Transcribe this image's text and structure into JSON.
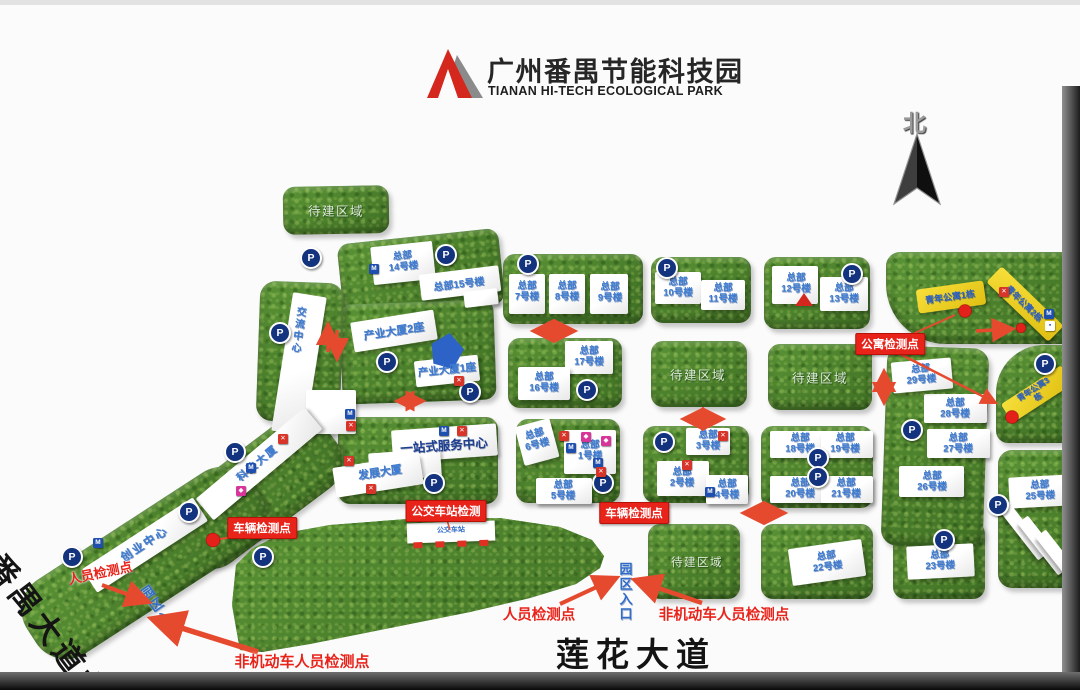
{
  "header": {
    "title": "广州番禺节能科技园",
    "subtitle": "TIANAN HI-TECH ECOLOGICAL PARK"
  },
  "compass": {
    "north": "北"
  },
  "roads": {
    "west": "番禺大道北",
    "south": "莲花大道"
  },
  "areas": {
    "pending": "待建区域"
  },
  "buildings": {
    "hq1": "总部\n1号楼",
    "hq2": "总部\n2号楼",
    "hq3": "总部\n3号楼",
    "hq4": "总部\n4号楼",
    "hq5": "总部\n5号楼",
    "hq6": "总部\n6号楼",
    "hq7": "总部\n7号楼",
    "hq8": "总部\n8号楼",
    "hq9": "总部\n9号楼",
    "hq10": "总部\n10号楼",
    "hq11": "总部\n11号楼",
    "hq12": "总部\n12号楼",
    "hq13": "总部\n13号楼",
    "hq14": "总部\n14号楼",
    "hq15": "总部15号楼",
    "hq16": "总部\n16号楼",
    "hq17": "总部\n17号楼",
    "hq18": "总部\n18号楼",
    "hq19": "总部\n19号楼",
    "hq20": "总部\n20号楼",
    "hq21": "总部\n21号楼",
    "hq22": "总部\n22号楼",
    "hq23": "总部\n23号楼",
    "hq25": "总部\n25号楼",
    "hq26": "总部\n26号楼",
    "hq27": "总部\n27号楼",
    "hq28": "总部\n28号楼",
    "hq29": "总部\n29号楼",
    "industry1": "产业大厦1座",
    "industry2": "产业大厦2座",
    "exchange": "交流中心",
    "startup": "创业中心",
    "tech": "科技大厦",
    "onestop": "一站式服务中心",
    "develop": "发展大厦",
    "apt1": "青年公寓1栋",
    "apt2": "青年公寓2栋",
    "apt3": "青年公寓3栋"
  },
  "checkpoints": {
    "apartment": "公寓检测点",
    "vehicle": "车辆检测点",
    "bus": "公交车站检测",
    "person": "人员检测点",
    "nonmotor": "非机动车人员检测点",
    "entrance": "园区入口",
    "bus_stop": "公交车站"
  },
  "icons": {
    "parking": "P"
  },
  "colors": {
    "grass": "#4c8330",
    "building_label": "#3d7bd0",
    "alert": "#e8291c",
    "apartment_fill": "#f2d32b",
    "parking_bg": "#14337f"
  }
}
